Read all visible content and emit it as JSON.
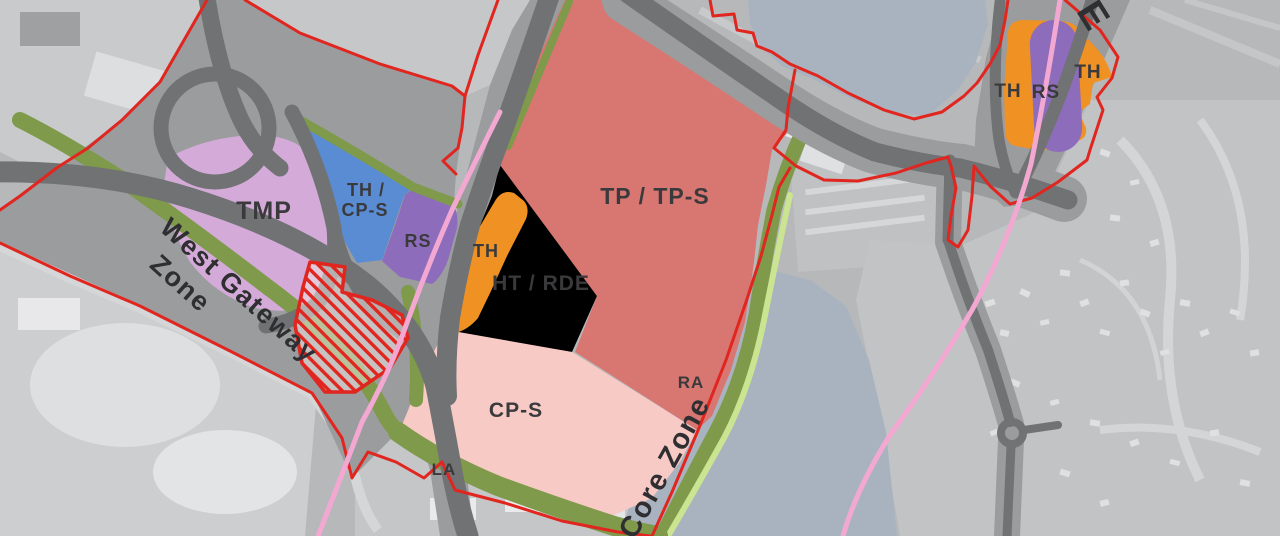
{
  "map": {
    "parcel_labels": {
      "tmp": "TMP",
      "th_cps_line1": "TH /",
      "th_cps_line2": "CP-S",
      "rs_west": "RS",
      "th_west": "TH",
      "ht_rde": "HT / RDE",
      "tp_tps": "TP / TP-S",
      "cp_s": "CP-S",
      "ra": "RA",
      "la": "LA",
      "th_east_left": "TH",
      "rs_east": "RS",
      "th_east_right": "TH"
    },
    "zone_names": {
      "west_gateway_line1": "West Gateway",
      "west_gateway_line2": "Zone",
      "core": "Core Zone",
      "east_partial": "E"
    },
    "colors": {
      "boundary_red": "#e1251f",
      "rail_pink": "#f3a8d2",
      "green_buffer": "#7e9a4a",
      "green_path": "#cbe492",
      "water": "#a9b3c0",
      "road_dark": "#707274",
      "road_light": "#9b9c9e",
      "zone_tmp": "#d4abd8",
      "zone_blue": "#5a8cd3",
      "zone_purple_rs": "#8d6dbb",
      "zone_orange_th": "#f09123",
      "zone_yellow_ht": "#f7d469",
      "zone_red_tp": "#d87672",
      "zone_pink_cps": "#f8cac5"
    }
  }
}
